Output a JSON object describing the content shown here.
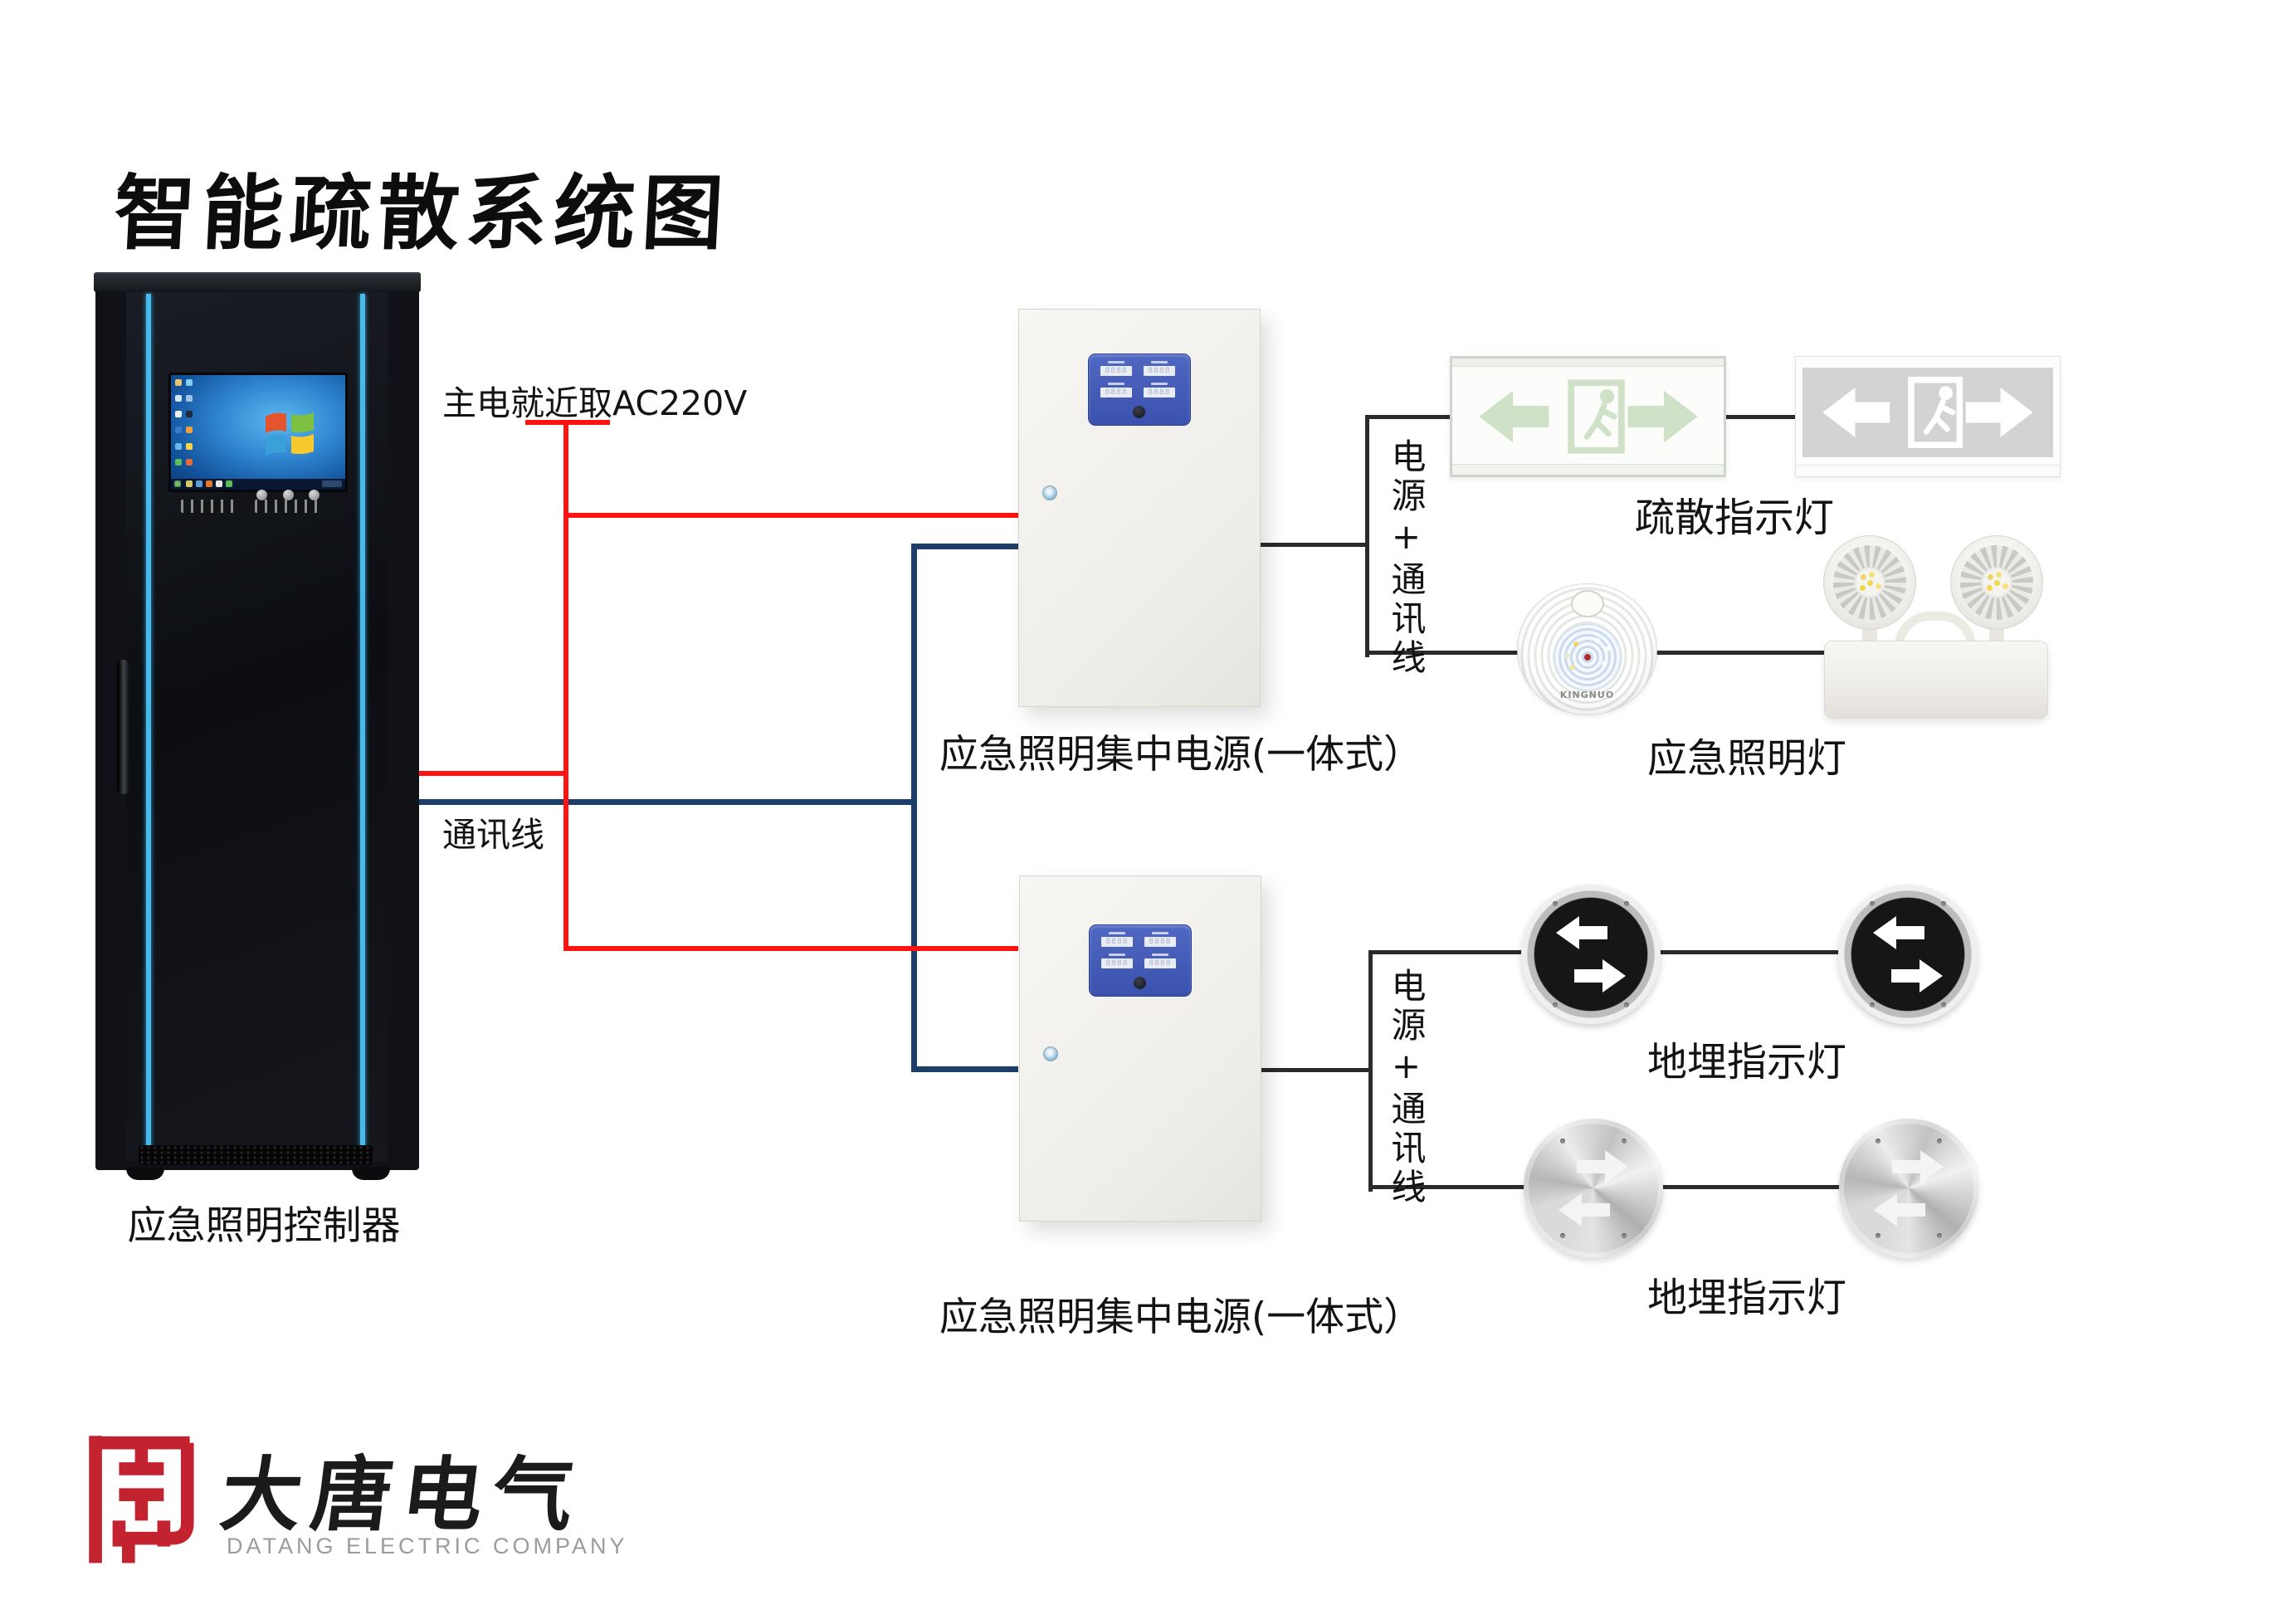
{
  "title": "智能疏散系统图",
  "cabinet": {
    "label": "应急照明控制器"
  },
  "wiring": {
    "main_power_label": "主电就近取AC220V",
    "comm_label": "通讯线",
    "branch1_label": "电源+通讯线",
    "branch2_label": "电源+通讯线",
    "colors": {
      "power": "#fd1412",
      "comm": "#1d3e68",
      "device": "#2b2b2b"
    }
  },
  "power_boxes": [
    {
      "label": "应急照明集中电源(一体式）"
    },
    {
      "label": "应急照明集中电源(一体式）"
    }
  ],
  "devices": {
    "exit_signs": {
      "label": "疏散指示灯"
    },
    "emergency_lights": {
      "label": "应急照明灯",
      "brand": "KINGNUO"
    },
    "buried_row1": {
      "label": "地埋指示灯"
    },
    "buried_row2": {
      "label": "地埋指示灯"
    }
  },
  "logo": {
    "name": "大唐电气",
    "subtitle": "DATANG ELECTRIC COMPANY",
    "seal_color": "#c2232e"
  },
  "accent_colors": {
    "cabinet_stripe": "#49b9ea",
    "panel_blue": "#3f57b4"
  }
}
